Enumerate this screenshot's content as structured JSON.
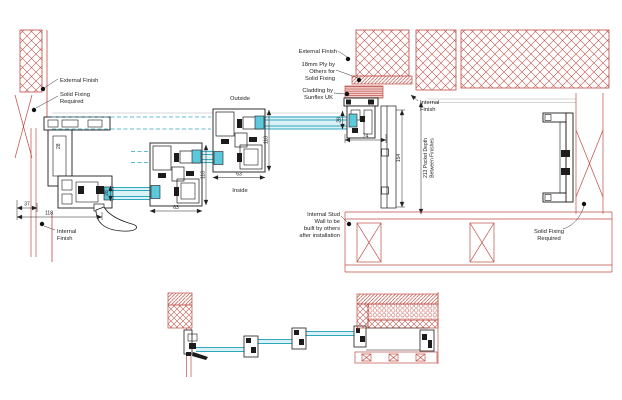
{
  "drawing": {
    "description": "Architectural CAD detail of a sliding/stacking glass door system with wall pocket (plan sections)",
    "colors": {
      "wall_red": "#bf4a42",
      "profile_black": "#1c1c1c",
      "glass_teal": "#2fa8bf",
      "glass_fill": "#daf1f6",
      "spacer_cyan": "#5cc8dc",
      "finish_gray": "#aaaaaa",
      "background": "#ffffff"
    }
  },
  "labels": {
    "external_finish_left": [
      "External Finish"
    ],
    "solid_fixing_left": [
      "Solid Fixing",
      "Required"
    ],
    "internal_finish_left": [
      "Internal",
      "Finish"
    ],
    "outside": "Outside",
    "inside": "Inside",
    "external_finish_right": [
      "External Finish"
    ],
    "ply_note": [
      "18mm Ply by",
      "Others for",
      "Solid Fixing"
    ],
    "cladding_note": [
      "Cladding by",
      "Sunflex UK"
    ],
    "internal_finish_right": [
      "Internal",
      "Finish"
    ],
    "internal_stud_note": [
      "Internal Stud",
      "Wall to be",
      "built by others",
      "after installation"
    ],
    "solid_fixing_right": [
      "Solid Fixing",
      "Required"
    ]
  },
  "dimensions": {
    "lock_jamb_offset": "37",
    "lock_jamb_width": "118",
    "frame_depth": "28",
    "glass_left": "28",
    "glass_right": "28",
    "interlock_width_1": "63",
    "interlock_width_2": "63",
    "interlock_depth_1": "118",
    "interlock_depth_2": "118",
    "pocket_entry_width": "74",
    "pocket_inner_depth": "154",
    "pocket_depth_note": [
      "213 Pocket Depth",
      "Between Finishes"
    ]
  }
}
